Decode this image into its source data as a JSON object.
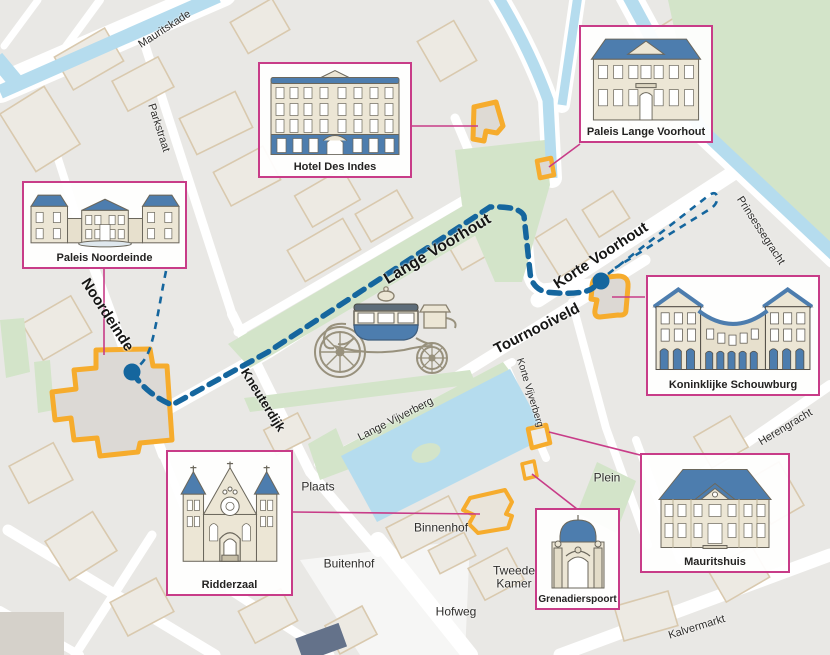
{
  "map_title": "Route Gouden Koets door Den Haag",
  "colors": {
    "route_blue": "#15669e",
    "accent_orange": "#f6ac2d",
    "card_border": "#c83c88",
    "water": "#b5dcee",
    "park_green": "#d3e4c9",
    "block_gray": "#e9e8e5",
    "street_white": "#ffffff",
    "building_outline_beige": "#d9c9ae",
    "roof_blue": "#4d7dae",
    "facade_cream": "#ece6d5"
  },
  "icons": {
    "golden_coach": "golden-coach-illustration",
    "route_start": "route-start-dot",
    "route_end": "route-end-dot"
  },
  "street_labels": [
    {
      "text": "Mauritskade",
      "x": 165,
      "y": 30,
      "rot": -33,
      "size": 11,
      "bold": false
    },
    {
      "text": "Parkstraat",
      "x": 158,
      "y": 128,
      "rot": 72,
      "size": 11,
      "bold": false
    },
    {
      "text": "Noordeinde",
      "x": 107,
      "y": 315,
      "rot": 57,
      "size": 15,
      "bold": true
    },
    {
      "text": "Kneuterdijk",
      "x": 263,
      "y": 400,
      "rot": 58,
      "size": 13,
      "bold": true
    },
    {
      "text": "Lange Voorhout",
      "x": 438,
      "y": 250,
      "rot": -31,
      "size": 16,
      "bold": true
    },
    {
      "text": "Korte Voorhout",
      "x": 601,
      "y": 256,
      "rot": -33,
      "size": 15,
      "bold": true
    },
    {
      "text": "Tournooiveld",
      "x": 537,
      "y": 329,
      "rot": -27,
      "size": 15,
      "bold": true
    },
    {
      "text": "Lange Vijverberg",
      "x": 396,
      "y": 420,
      "rot": -27,
      "size": 11,
      "bold": false
    },
    {
      "text": "Korte Vijverberg",
      "x": 529,
      "y": 393,
      "rot": 73,
      "size": 10,
      "bold": false
    },
    {
      "text": "Prinsessegracht",
      "x": 760,
      "y": 231,
      "rot": 57,
      "size": 11,
      "bold": false
    },
    {
      "text": "Herengracht",
      "x": 786,
      "y": 428,
      "rot": -31,
      "size": 11,
      "bold": false
    },
    {
      "text": "Kalvermarkt",
      "x": 697,
      "y": 628,
      "rot": -17,
      "size": 11,
      "bold": false
    },
    {
      "text": "Plaats",
      "x": 318,
      "y": 487,
      "rot": 0,
      "size": 12,
      "bold": false
    },
    {
      "text": "Buitenhof",
      "x": 349,
      "y": 564,
      "rot": 0,
      "size": 12,
      "bold": false
    },
    {
      "text": "Binnenhof",
      "x": 441,
      "y": 528,
      "rot": 0,
      "size": 12,
      "bold": false
    },
    {
      "text": "Tweede\nKamer",
      "x": 514,
      "y": 577,
      "rot": 0,
      "size": 12,
      "bold": false
    },
    {
      "text": "Hofweg",
      "x": 456,
      "y": 612,
      "rot": 0,
      "size": 12,
      "bold": false
    },
    {
      "text": "Plein",
      "x": 607,
      "y": 478,
      "rot": 0,
      "size": 12,
      "bold": false
    }
  ],
  "cards": [
    {
      "id": "paleis-noordeinde",
      "label": "Paleis Noordeinde"
    },
    {
      "id": "hotel-des-indes",
      "label": "Hotel Des Indes"
    },
    {
      "id": "paleis-lange-voorhout",
      "label": "Paleis Lange Voorhout"
    },
    {
      "id": "koninklijke-schouwburg",
      "label": "Koninklijke Schouwburg"
    },
    {
      "id": "mauritshuis",
      "label": "Mauritshuis"
    },
    {
      "id": "grenadierspoort",
      "label": "Grenadierspoort"
    },
    {
      "id": "ridderzaal",
      "label": "Ridderzaal"
    }
  ]
}
